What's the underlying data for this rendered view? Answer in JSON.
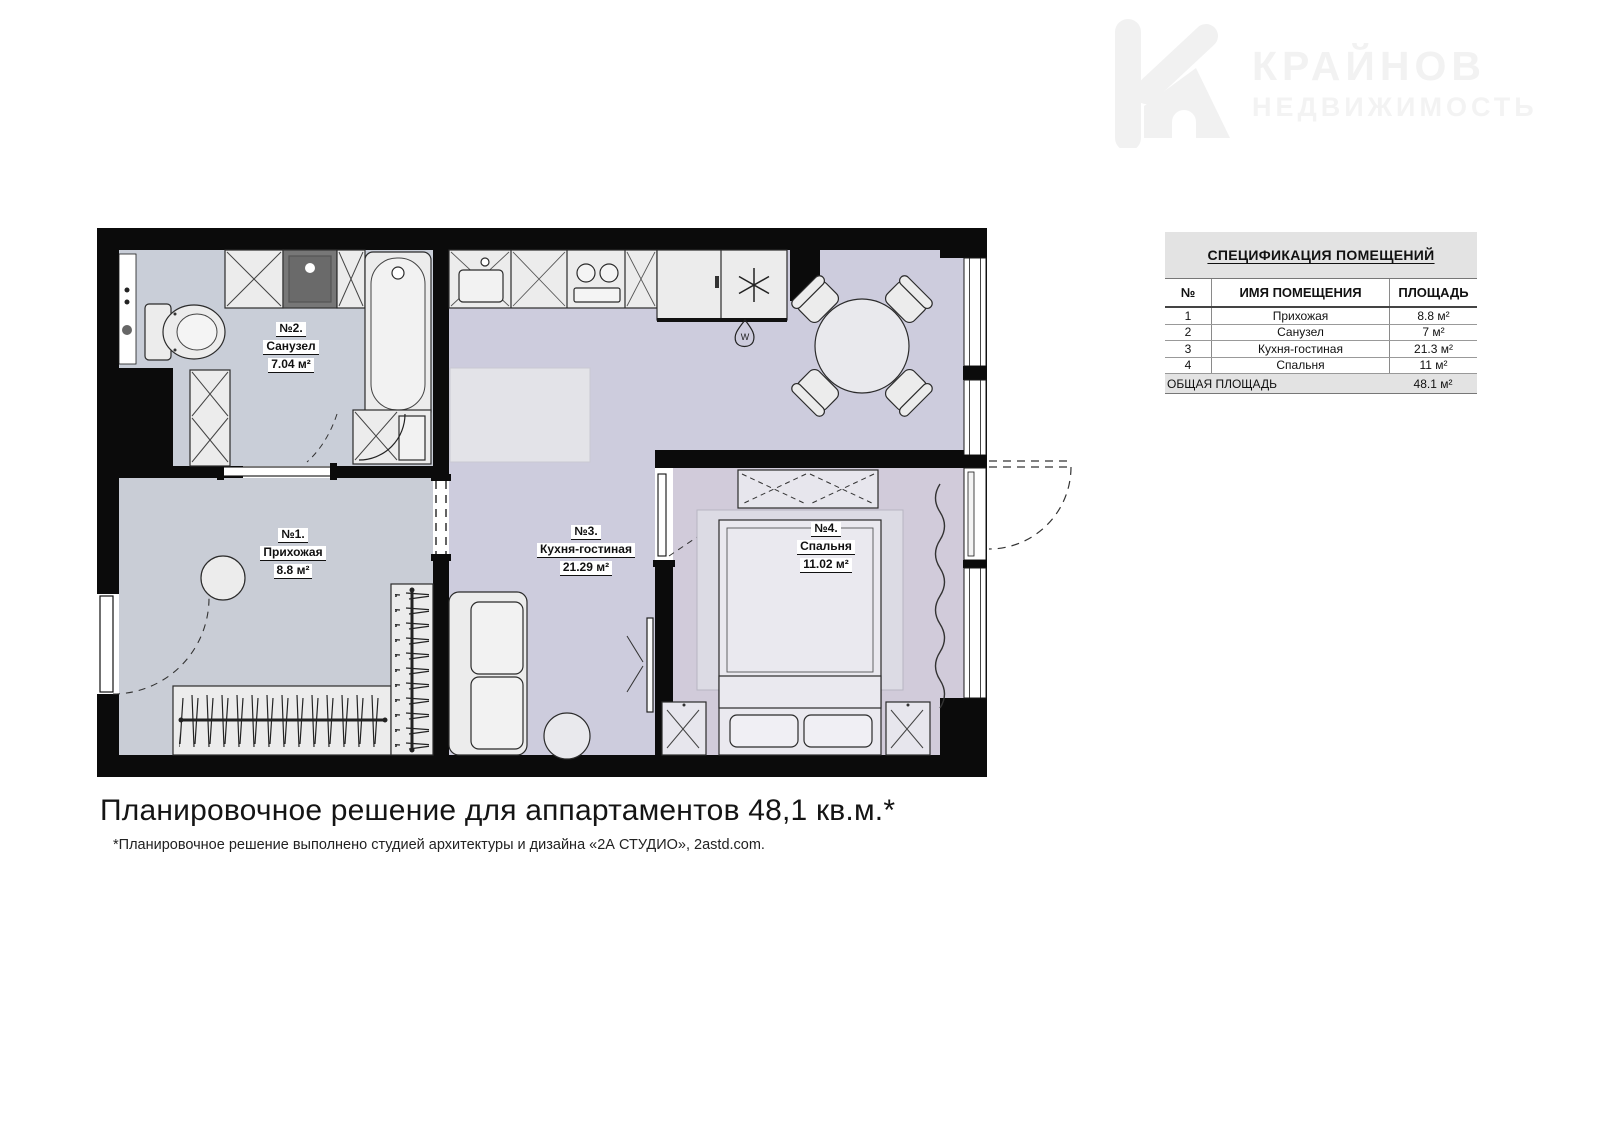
{
  "logo": {
    "brand_line1": "КРАЙНОВ",
    "brand_line2": "НЕДВИЖИМОСТЬ"
  },
  "spec_table": {
    "title": "СПЕЦИФИКАЦИЯ ПОМЕЩЕНИЙ",
    "columns": [
      "№",
      "ИМЯ ПОМЕЩЕНИЯ",
      "ПЛОЩАДЬ"
    ],
    "rows": [
      {
        "num": "1",
        "name": "Прихожая",
        "area": "8.8 м²"
      },
      {
        "num": "2",
        "name": "Санузел",
        "area": "7 м²"
      },
      {
        "num": "3",
        "name": "Кухня-гостиная",
        "area": "21.3 м²"
      },
      {
        "num": "4",
        "name": "Спальня",
        "area": "11 м²"
      }
    ],
    "total_label": "ОБЩАЯ ПЛОЩАДЬ",
    "total_area": "48.1 м²"
  },
  "floor_plan": {
    "rooms": [
      {
        "number": "№1.",
        "name": "Прихожая",
        "area": "8.8 м²"
      },
      {
        "number": "№2.",
        "name": "Санузел",
        "area": "7.04 м²"
      },
      {
        "number": "№3.",
        "name": "Кухня-гостиная",
        "area": "21.29 м²"
      },
      {
        "number": "№4.",
        "name": "Спальня",
        "area": "11.02 м²"
      }
    ],
    "icons": {
      "boiler_letter": "W"
    },
    "colors": {
      "wall": "#0b0b0b",
      "bathroom_floor": "#c9ced8",
      "hallway_floor": "#c9cdd6",
      "living_floor": "#cdccdd",
      "bedroom_floor": "#d1cbda",
      "furniture": "#ececec"
    }
  },
  "caption": {
    "title": "Планировочное решение для аппартаментов 48,1 кв.м.*",
    "footnote": "*Планировочное решение выполнено студией архитектуры и дизайна «2А СТУДИО», 2astd.com."
  }
}
